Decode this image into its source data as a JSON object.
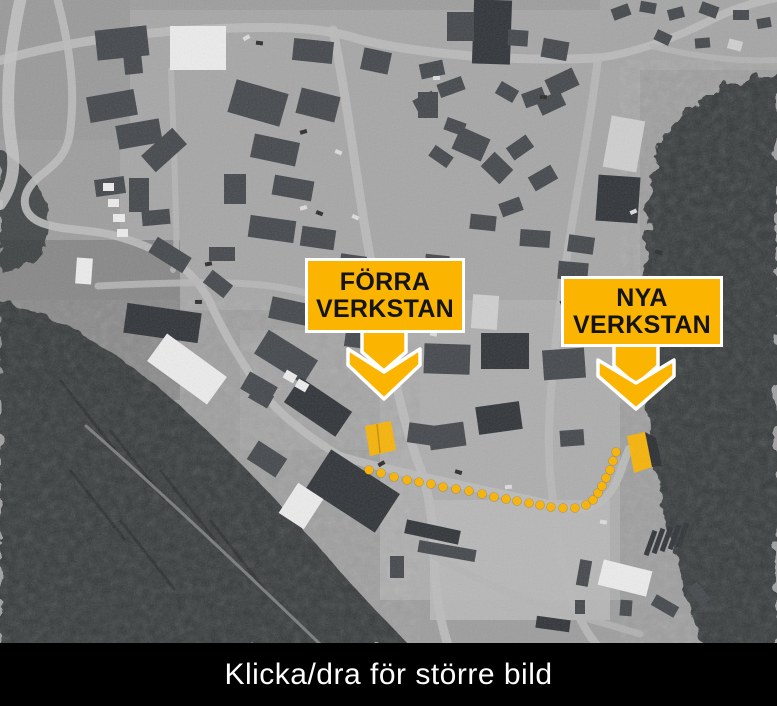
{
  "markers": [
    {
      "label": "FÖRRA VERKSTAN"
    },
    {
      "label": "NYA VERKSTAN"
    }
  ],
  "route": {
    "dots": [
      [
        369,
        470
      ],
      [
        381,
        473
      ],
      [
        394,
        477
      ],
      [
        407,
        480
      ],
      [
        419,
        482
      ],
      [
        431,
        484
      ],
      [
        443,
        487
      ],
      [
        456,
        489
      ],
      [
        469,
        491
      ],
      [
        482,
        494
      ],
      [
        494,
        497
      ],
      [
        506,
        499
      ],
      [
        517,
        501
      ],
      [
        529,
        503
      ],
      [
        540,
        505
      ],
      [
        551,
        507
      ],
      [
        563,
        508
      ],
      [
        575,
        508
      ],
      [
        586,
        505
      ],
      [
        593,
        500
      ],
      [
        598,
        493
      ],
      [
        602,
        486
      ],
      [
        606,
        478
      ],
      [
        610,
        470
      ],
      [
        613,
        461
      ],
      [
        616,
        452
      ]
    ]
  },
  "caption": {
    "text": "Klicka/dra för större bild"
  },
  "colors": {
    "highlight": "#FBB400",
    "marker_text": "#141414",
    "marker_border": "#FFFFFF",
    "caption_bg": "#000000",
    "caption_text": "#FFFFFF"
  }
}
